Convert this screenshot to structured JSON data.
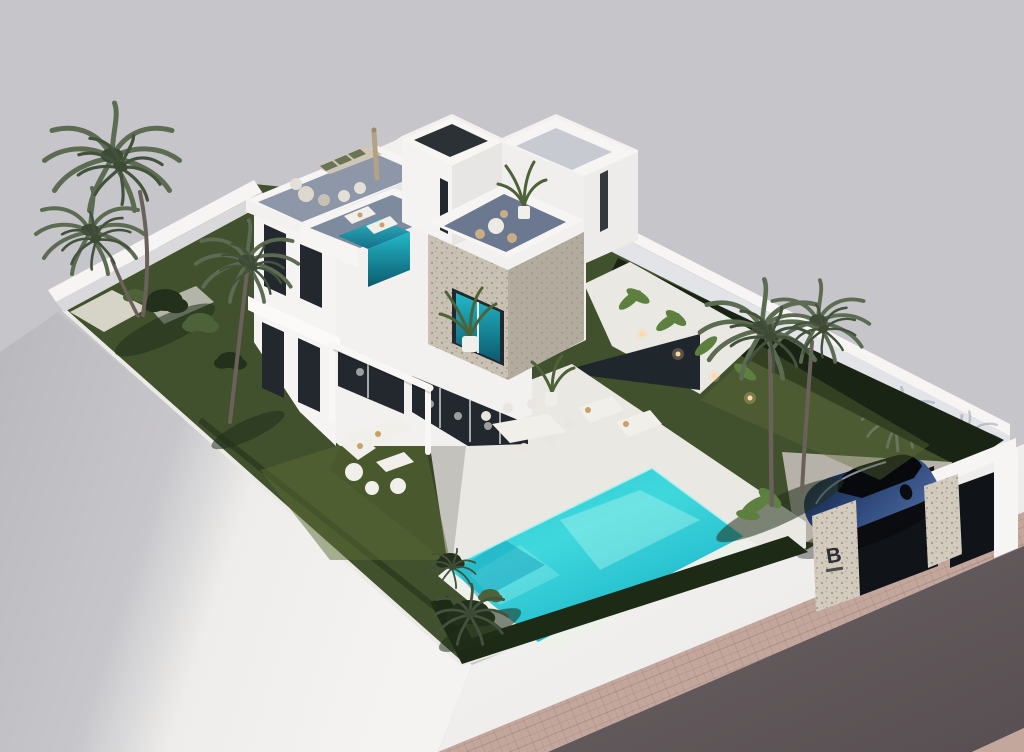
{
  "scene": {
    "logo_letter": "B"
  },
  "colors": {
    "background": "#c6c5ca",
    "plinth_light": "#f3f2f0",
    "plinth_shadow": "#bcbbc0",
    "road": "#5f5558",
    "sidewalk": "#c3a69c",
    "lawn": "#42512d",
    "lawn_light": "#5c6c36",
    "lawn_shadow": "#22301c",
    "hedge": "#1d2a16",
    "planting_bed": "#1a2415",
    "deck": "#e9e8e2",
    "path_gray": "#b2b5a8",
    "gravel": "#d6d4c6",
    "wall_white": "#f6f5f3",
    "wall_shade": "#e3e4e8",
    "house_white": "#f2f1ef",
    "house_shade": "#e6e5e4",
    "stone_light": "#c9c2b4",
    "stone_dark": "#b3ac9e",
    "stone_speckle": "#8f887a",
    "terrace_floor": "#7e8a9e",
    "roof_terrace_floor": "#8e97a7",
    "glass_dark": "#22282e",
    "glass_teal": "#1fb4c4",
    "plunge_teal": "#2aa6bb",
    "pool": "#2cc9d6",
    "pool_light": "#a8f2ee",
    "pool_deep": "#0f9fbb",
    "coping": "#eef0ea",
    "palm_frond": "#5c6b52",
    "palm_frond_dark": "#43523c",
    "palm_trunk": "#6a625a",
    "plant_green": "#4d6238",
    "banana_green": "#5d8040",
    "car_body": "#16294e",
    "car_glass": "#07090d",
    "car_highlight": "#b9c6e2",
    "gate": "#101317",
    "pillar_stone": "#d3cbbd",
    "logo": "#2a2d33",
    "umbrella": "#b3a284",
    "furniture": "#f1efe9",
    "cushion_tan": "#c8a06a",
    "cushion_green": "#687455",
    "light_warm": "#ffd9a2",
    "shadow_wall": "#97a1b4"
  }
}
